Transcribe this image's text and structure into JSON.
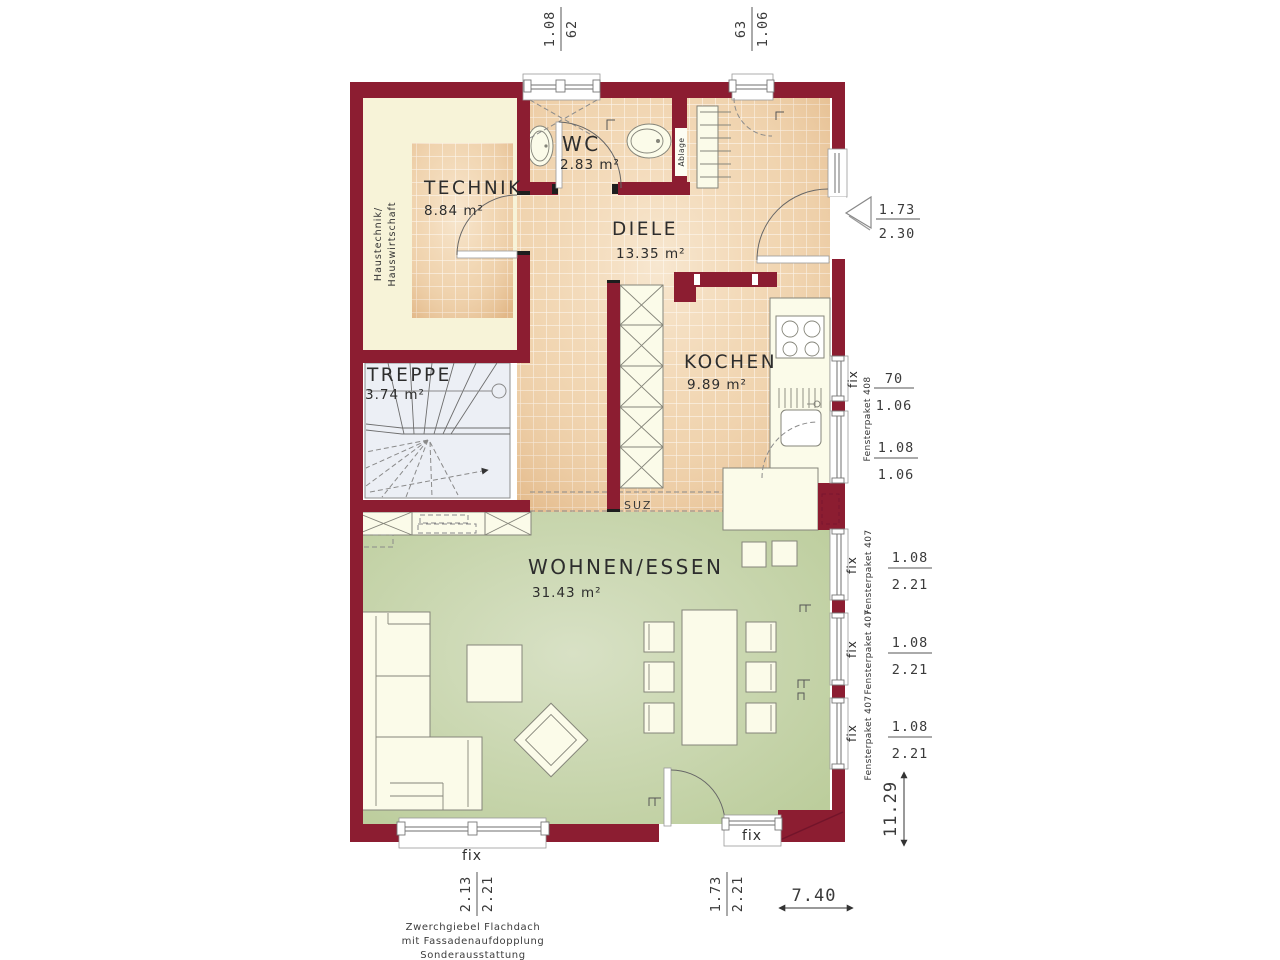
{
  "rooms": {
    "technik": {
      "name": "TECHNIK",
      "area": "8.84 m²"
    },
    "wc": {
      "name": "WC",
      "area": "2.83 m²"
    },
    "diele": {
      "name": "DIELE",
      "area": "13.35 m²"
    },
    "kochen": {
      "name": "KOCHEN",
      "area": "9.89 m²"
    },
    "treppe": {
      "name": "TREPPE",
      "area": "3.74 m²"
    },
    "wohnen_essen": {
      "name": "WOHNEN/ESSEN",
      "area": "31.43 m²"
    }
  },
  "labels": {
    "haustechnik_line1": "Haustechnik/",
    "haustechnik_line2": "Hauswirtschaft",
    "ablage": "Ablage",
    "suz": "SUZ",
    "fix": "fix",
    "fensterpaket_407": "Fensterpaket 407",
    "fensterpaket_408": "Fensterpaket 408"
  },
  "dimensions": {
    "top_window_left": {
      "width": "1.08",
      "sill": "62"
    },
    "top_window_right": {
      "width": "63",
      "sill": "1.06"
    },
    "entrance_door": {
      "width": "1.73",
      "height": "2.30"
    },
    "kitchen_window_small": {
      "width": "70",
      "height": "1.06"
    },
    "kitchen_window_large": {
      "width": "1.08",
      "height": "1.06"
    },
    "living_window": {
      "width": "1.08",
      "height": "2.21"
    },
    "bottom_window": {
      "width": "2.13",
      "height": "2.21"
    },
    "terrace_door": {
      "width": "1.73",
      "height": "2.21"
    },
    "total_width": "7.40",
    "total_height": "11.29"
  },
  "footer": {
    "line1": "Zwerchgiebel Flachdach",
    "line2": "mit Fassadenaufdopplung",
    "line3": "Sonderausstattung"
  },
  "colors": {
    "wall": "#8c1d31",
    "tile_floor": "#eed0a9",
    "living_floor": "#c9d6ae",
    "furniture": "#fbfbe9",
    "stairs": "#eceff5"
  }
}
